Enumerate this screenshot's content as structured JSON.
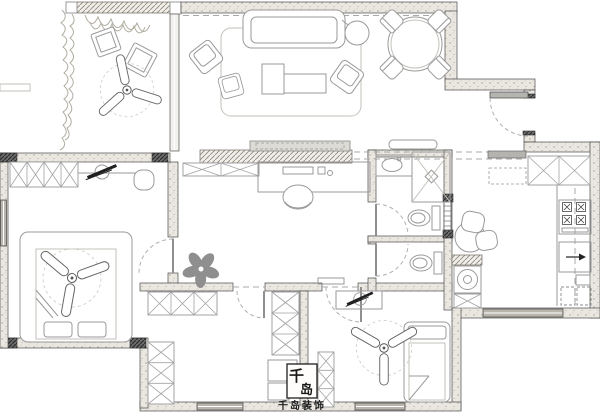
{
  "canvas": {
    "width": 600,
    "height": 418,
    "background": "#ffffff"
  },
  "palette": {
    "wall_stroke": "#4a4a4a",
    "wall_fill": "#eae7e1",
    "furniture_line": "#9a9a9a",
    "door_arc": "#b0b0b0",
    "dark_accent": "#1f1f1f",
    "plant_gray": "#8f8f8f"
  },
  "watermark": {
    "stamp_top": "千",
    "stamp_bottom": "岛",
    "caption": "千岛装饰"
  },
  "legend": {
    "drawing_type": "apartment floor plan",
    "rooms": [
      {
        "name": "balcony",
        "symbols": [
          "climbing-plant",
          "hanging-plant",
          "floor-cushions",
          "ceiling-fan"
        ]
      },
      {
        "name": "living-room",
        "symbols": [
          "sofa",
          "armchairs",
          "coffee-table",
          "rug",
          "side-table",
          "tv-cabinet"
        ]
      },
      {
        "name": "dining-area",
        "symbols": [
          "round-table",
          "four-chairs"
        ]
      },
      {
        "name": "entry",
        "symbols": [
          "entry-door-swing"
        ]
      },
      {
        "name": "kitchen",
        "symbols": [
          "upper-cabinets",
          "cooktop",
          "sink",
          "counter"
        ]
      },
      {
        "name": "bathroom",
        "symbols": [
          "shower",
          "wash-basin",
          "toilet",
          "sliding-door"
        ]
      },
      {
        "name": "second-wc",
        "symbols": [
          "toilet"
        ]
      },
      {
        "name": "study",
        "symbols": [
          "desk",
          "computer",
          "office-chair",
          "flower-ornament"
        ]
      },
      {
        "name": "master-bedroom",
        "symbols": [
          "double-bed",
          "ceiling-fan",
          "wardrobe",
          "shelf-plant",
          "chair"
        ]
      },
      {
        "name": "bedroom-two",
        "symbols": [
          "wardrobes",
          "desk"
        ]
      },
      {
        "name": "bedroom-three",
        "symbols": [
          "single-bed",
          "ceiling-fan",
          "desk",
          "wardrobe"
        ]
      },
      {
        "name": "hallway",
        "symbols": [
          "breakfast-table",
          "washing-machine"
        ]
      }
    ]
  }
}
